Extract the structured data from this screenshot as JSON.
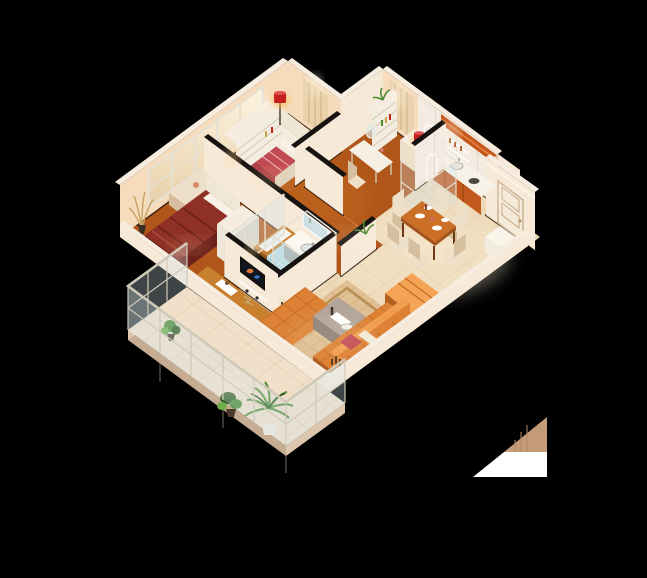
{
  "scene": {
    "description": "3D isometric cutaway render of an apartment floor plan, viewed from above at an angle, on a solid black background",
    "style": "photoreal-isometric-cutaway",
    "background": "#000000",
    "artifacts": [
      "tan-and-white-triangle-render-artifact-bottom-right"
    ]
  },
  "palette": {
    "background": "#000000",
    "wallLit": "#f7e9d8",
    "wallWarm": "#f6dcbc",
    "wallShade": "#e3c3a0",
    "wallDark": "#d4ad88",
    "wallTop": "#f6ece0",
    "wallTopDark": "#171310",
    "blackTrim": "#2a1a0d",
    "woodFloor": "#b0561a",
    "woodLit": "#cf6f22",
    "woodDark": "#8a3f0e",
    "tileFloor": "#edd9b8",
    "tileLight": "#f7ecd4",
    "tileGrout": "#d9ba92",
    "mosaic": "#b7d8de",
    "mosaicLight": "#e4f1f3",
    "balconyFloor": "#f0e0ca",
    "slabEdge": "#dcc6ae",
    "slabShade": "#c6ac92",
    "glassFill": "#d2e6eb",
    "glassFrame": "#e6e0d2",
    "railFrame": "#cfc9b8",
    "curtain": "#ead2ac",
    "curtainShade": "#d3b488",
    "doorFace": "#f4ead9",
    "doorLine": "#cbb291",
    "cabinetOrange": "#c35a1d",
    "cabinetDark": "#9e4412",
    "counter": "#f7f2e8",
    "soffit": "#c4581b",
    "sofa": "#dd8135",
    "sofaLit": "#f09d4e",
    "sofaDark": "#b35f1f",
    "sofaLine": "#c06c26",
    "chaiseLit": "#f5a455",
    "carpet": "#dfbf93",
    "carpetLine": "#c8a471",
    "carpetBorder": "#b98f55",
    "taupe": "#b2a499",
    "taupeDark": "#8e7e74",
    "woodFurn": "#c8802f",
    "woodFurnDark": "#935a1e",
    "diningWood": "#cb7026",
    "diningWoodDark": "#a3541a",
    "chairCream": "#eee0c8",
    "chairShade": "#d6bf9e",
    "maroon": "#8e3026",
    "maroonDark": "#6b2019",
    "maroonLit": "#b04a36",
    "blanketRed": "#c24a52",
    "blanketPink": "#eba6ad",
    "mattress": "#f4ecdf",
    "pillow": "#f8f2e6",
    "lampRed": "#c51f1f",
    "lampGlow": "#ffbe5e",
    "plantGreen": "#4c8a33",
    "plantDark": "#2f5c20",
    "plantLight": "#6fae4a",
    "plantTan": "#c9a162",
    "potWhite": "#efe9dd",
    "white": "#ffffff",
    "artifactTan": "#c49b79",
    "glowWarm": "#ffd9a0",
    "glowWhite": "#fff6e6",
    "tvDark": "#0e1622"
  },
  "rooms": [
    {
      "id": "master-bedroom",
      "floor": "wood",
      "furniture": [
        "double-bed-pink-runner",
        "white-headboard",
        "shelf-dresser",
        "red-drum-floor-lamp",
        "curtain-panel"
      ]
    },
    {
      "id": "second-bedroom",
      "floor": "wood",
      "furniture": [
        "double-bed-maroon",
        "pillows",
        "dresser",
        "window-chaise",
        "dried-plant-vase",
        "window-wall"
      ]
    },
    {
      "id": "study",
      "floor": "wood",
      "furniture": [
        "bookshelf",
        "vanity-desk-with-mirror",
        "chair",
        "sideboard",
        "red-table-lamp",
        "curtain-panel"
      ]
    },
    {
      "id": "bathroom",
      "floor": "blue-mosaic",
      "furniture": [
        "vanity-sink",
        "mirror",
        "bathtub",
        "toilet",
        "glass-shower-cube",
        "glass-partition"
      ]
    },
    {
      "id": "kitchen",
      "floor": "tile",
      "furniture": [
        "orange-base-cabinets",
        "counter-sink",
        "cooktop",
        "orange-soffit",
        "wall-shelves",
        "glass-pantry-cube",
        "tiled-wall"
      ]
    },
    {
      "id": "dining-area",
      "floor": "tile",
      "furniture": [
        "wood-dining-table",
        "six-cream-chairs",
        "tableware"
      ]
    },
    {
      "id": "living-room",
      "floor": "tile",
      "furniture": [
        "tufted-sectional-sofa",
        "tufted-bench-sofa",
        "bright-chaise",
        "taupe-coffee-table",
        "tv-partition-wall",
        "patterned-rug",
        "wood-console",
        "floor-lamp",
        "potted-plant",
        "candle-cluster"
      ]
    },
    {
      "id": "entry",
      "floor": "tile",
      "furniture": [
        "white-panel-door",
        "console-cabinet"
      ]
    },
    {
      "id": "balcony",
      "floor": "tile",
      "furniture": [
        "glass-metal-railing",
        "palm-in-white-pot",
        "potted-plants"
      ]
    }
  ]
}
